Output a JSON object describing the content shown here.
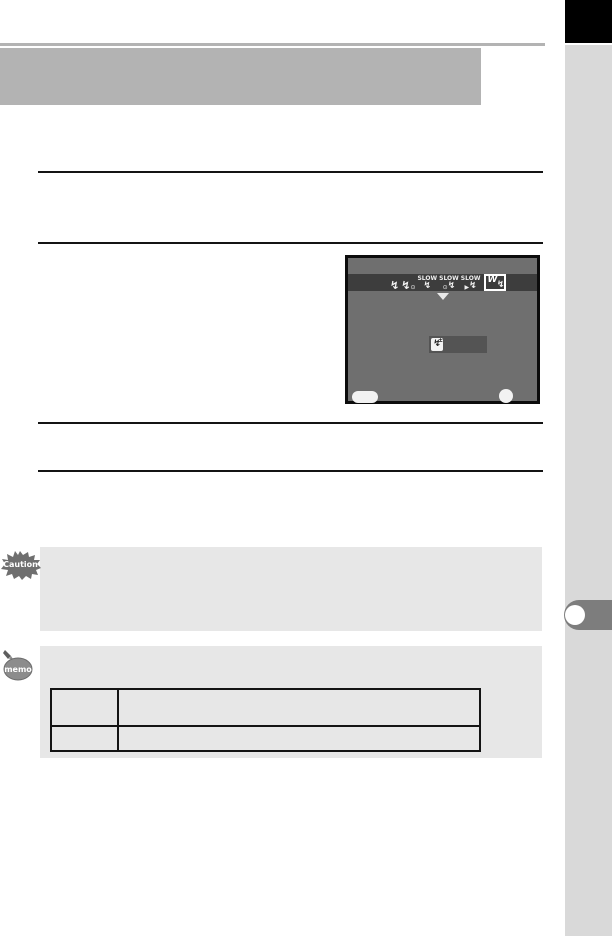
{
  "colors": {
    "header_gray": "#b3b3b3",
    "sidebar_gray": "#d9d9d9",
    "corner_black": "#000000",
    "tab_gray": "#7d7d7d",
    "note_box_gray": "#e7e7e7",
    "lcd_background": "#6f6f6f",
    "lcd_mode_bar": "#3d3d3d",
    "lcd_value_box": "#545454",
    "rule_black": "#141414"
  },
  "icons": {
    "flash_bolt": "↯",
    "red_eye": "⊙",
    "curtain_arrow": "▶",
    "plus_minus": "±"
  },
  "lcd_screen": {
    "flash_mode_bar": {
      "modes": [
        {
          "name": "flash-on",
          "label": ""
        },
        {
          "name": "flash-on-red-eye",
          "label": ""
        },
        {
          "name": "slow-speed-sync",
          "label": "SLOW"
        },
        {
          "name": "slow-speed-sync-red-eye",
          "label": "SLOW"
        },
        {
          "name": "trailing-curtain-sync",
          "label": "SLOW"
        },
        {
          "name": "wireless-mode",
          "label": "W",
          "selected": true
        }
      ]
    },
    "value_box": {
      "icon": "flash-exposure-compensation-icon",
      "value": ""
    },
    "bottom_buttons": {
      "pill_label": "",
      "ok_label": ""
    }
  },
  "caution_note": {
    "badge_label": "Caution",
    "text": ""
  },
  "memo_note": {
    "badge_label": "memo",
    "text": "",
    "table": {
      "rows": [
        [
          "",
          ""
        ],
        [
          "",
          ""
        ]
      ]
    }
  }
}
